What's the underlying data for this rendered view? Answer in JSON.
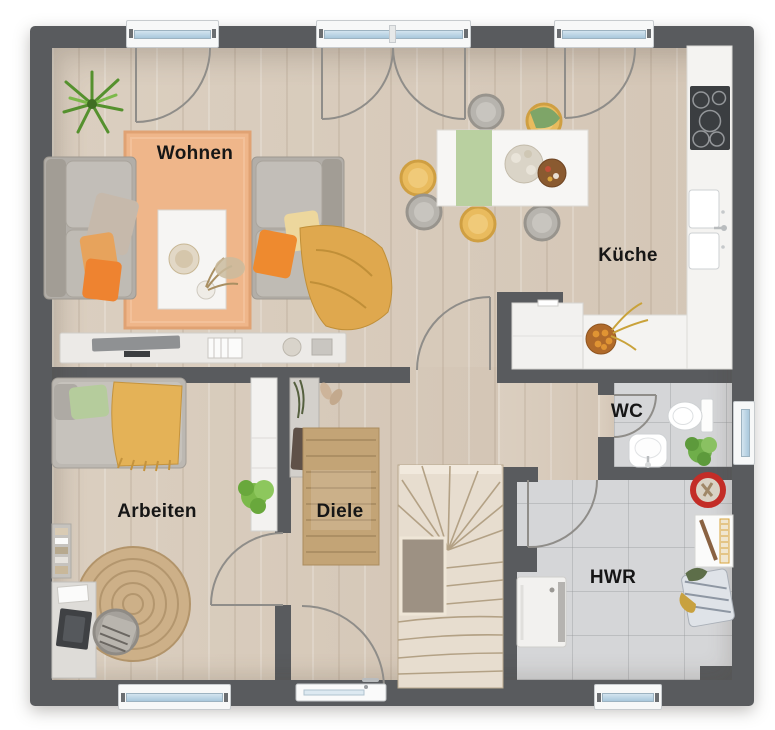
{
  "rooms": {
    "wohnen": {
      "label": "Wohnen"
    },
    "kueche": {
      "label": "Küche"
    },
    "arbeiten": {
      "label": "Arbeiten"
    },
    "diele": {
      "label": "Diele"
    },
    "wc": {
      "label": "WC"
    },
    "hwr": {
      "label": "HWR"
    }
  },
  "colors": {
    "wall": "#595b5e",
    "wood_floor": "#d8cbbc",
    "tile_floor": "#d5d6d8",
    "living_rug": "#efb68a",
    "jute_rug": "#c9ad80",
    "accent_orange": "#ef8a2f",
    "accent_mustard": "#e0ae52",
    "accent_green": "#b5cc9c",
    "window_glass": "#b7d3e4"
  },
  "fixtures": {
    "wohnen": [
      "sofa-left",
      "sofa-right",
      "coffee-table",
      "tv-lowboard",
      "plant",
      "area-rug"
    ],
    "kueche": [
      "counter-with-cooktop",
      "double-sink",
      "fridge",
      "dining-table",
      "six-chairs",
      "fruit-bowl"
    ],
    "arbeiten": [
      "daybed",
      "desk",
      "desk-chair",
      "bookshelf",
      "tall-cabinet",
      "round-rug",
      "plant"
    ],
    "diele": [
      "wardrobe",
      "runner-rug",
      "staircase",
      "entrance-door"
    ],
    "wc": [
      "toilet",
      "hand-basin",
      "plant",
      "window"
    ],
    "hwr": [
      "heating-unit",
      "laundry-basket",
      "shelf",
      "bucket",
      "window"
    ]
  }
}
